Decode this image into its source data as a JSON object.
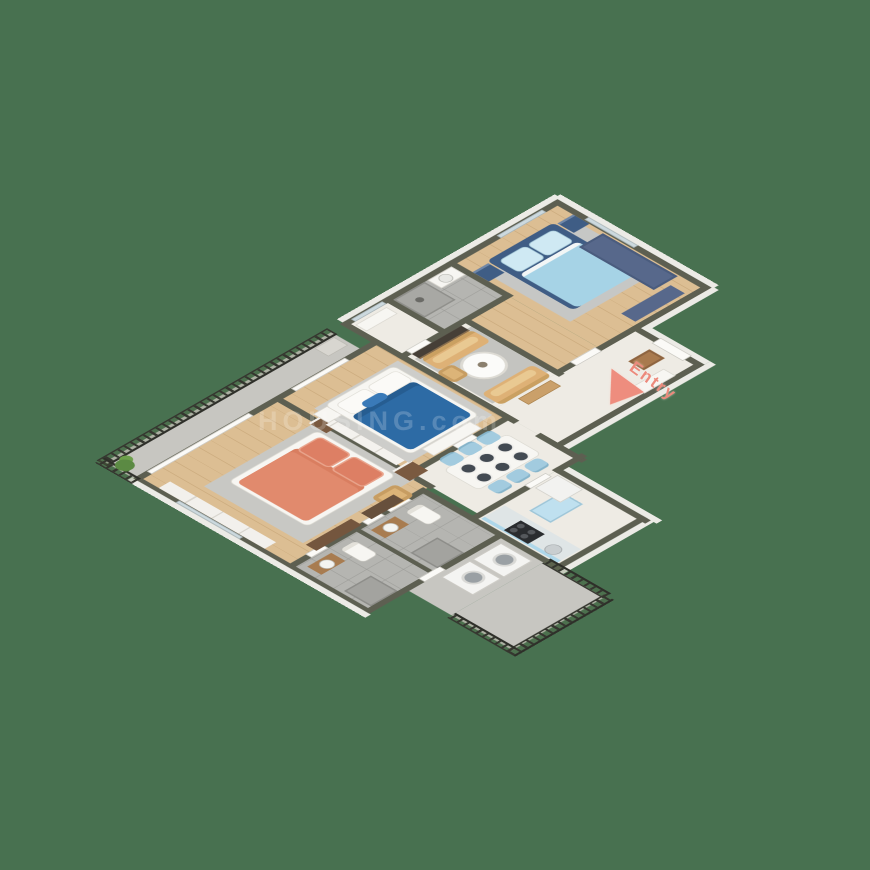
{
  "scene": {
    "description": "3D isometric rendering of an apartment floor plan on a plain green background",
    "background_color": "#487150"
  },
  "labels": {
    "entry": "Entry"
  },
  "watermark": {
    "text": "HOUSING.com"
  },
  "palette": {
    "wall_cap": "#5d5f51",
    "wall_face": "#ecebe6",
    "wood_floor": "#d8ba8f",
    "marble_floor": "#eeebe4",
    "bath_tile": "#b5b5b1",
    "balcony_concrete": "#c7c6c1",
    "railing": "#35362f",
    "master_bed_coral": "#e18a6d",
    "bedroom2_bed_blue": "#2d6ba5",
    "bedroom3_bed_lightblue": "#a6d3e6",
    "bedroom3_frame_navy": "#3f5d85",
    "sofa_tan": "#deb176",
    "dining_chair_blue": "#a2cbdf",
    "kitchen_cabinet_blue": "#aed7ea",
    "stove_black": "#2b2d2f",
    "entry_accent": "#ec8a7c",
    "plant_green": "#5b8a43"
  }
}
